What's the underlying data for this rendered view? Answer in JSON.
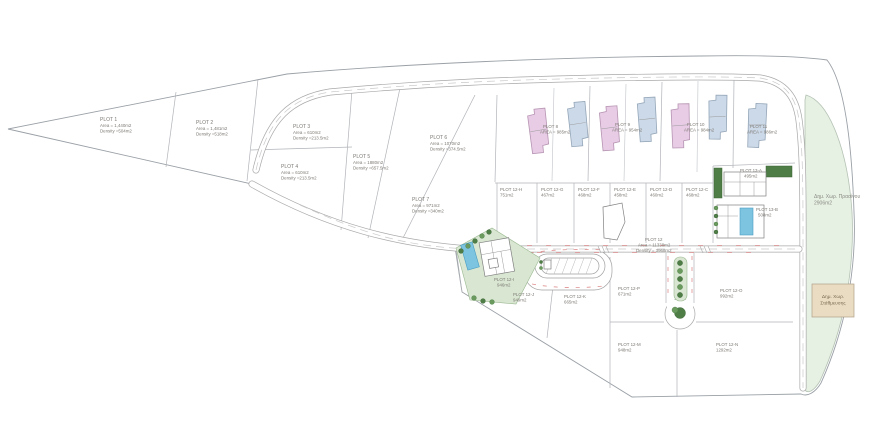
{
  "drawing": {
    "title": "Land development site plan",
    "type": "plot subdivision plan"
  },
  "plots": {
    "p1": {
      "name": "PLOT 1",
      "area": "Area = 1,440m2",
      "density": "Density =504m2"
    },
    "p2": {
      "name": "PLOT 2",
      "area": "Area = 1,481m2",
      "density": "Density =518m2"
    },
    "p3": {
      "name": "PLOT 3",
      "area": "Area = 610m2",
      "density": "Density =213.5m2"
    },
    "p4": {
      "name": "PLOT 4",
      "area": "Area = 610m2",
      "density": "Density =213.5m2"
    },
    "p5": {
      "name": "PLOT 5",
      "area": "Area = 1880m2",
      "density": "Density =657.5m2"
    },
    "p6": {
      "name": "PLOT 6",
      "area": "Area = 1070m2",
      "density": "Density =374.5m2"
    },
    "p7": {
      "name": "PLOT 7",
      "area": "Area = 971m2",
      "density": "Density =340m2"
    },
    "p8": {
      "name": "PLOT 8",
      "area": "AREA = 985m2"
    },
    "p9": {
      "name": "PLOT 9",
      "area": "AREA = 954m2"
    },
    "p10": {
      "name": "PLOT 10",
      "area": "AREA = 984m2"
    },
    "p11": {
      "name": "PLOT 11",
      "area": "AREA = 986m2"
    },
    "p12": {
      "name": "PLOT 12",
      "area": "Area = 11338m2",
      "density": "Density = 3968m2"
    },
    "p12c": {
      "name": "PLOT 12-C",
      "area": "468m2"
    },
    "p12d": {
      "name": "PLOT 12-D",
      "area": "460m2"
    },
    "p12e": {
      "name": "PLOT 12-E",
      "area": "458m2"
    },
    "p12f": {
      "name": "PLOT 12-F",
      "area": "468m2"
    },
    "p12g": {
      "name": "PLOT 12-G",
      "area": "467m2"
    },
    "p12h": {
      "name": "PLOT 12-H",
      "area": "751m2"
    },
    "p12i": {
      "name": "PLOT 12-I",
      "area": "946m2"
    },
    "p12j": {
      "name": "PLOT 12-J",
      "area": "949m2"
    },
    "p12k": {
      "name": "PLOT 12-K",
      "area": "665m2"
    },
    "p12m": {
      "name": "PLOT 12-M",
      "area": "948m2"
    },
    "p12n": {
      "name": "PLOT 12-N",
      "area": "1292m2"
    },
    "p12o": {
      "name": "PLOT 12-O",
      "area": "992m2"
    },
    "p12p": {
      "name": "PLOT 12-P",
      "area": "671m2"
    },
    "p13a": {
      "name": "PLOT 13-A",
      "area": "495m2"
    },
    "p13b": {
      "name": "PLOT 13-B",
      "area": "508m2"
    }
  },
  "public_areas": {
    "green_space": {
      "line1": "Δημ. Χωρ. Πρασίνου",
      "line2": "2906m2"
    },
    "parking": {
      "line1": "Δημ. Χωρ.",
      "line2": "Στάθμευσης"
    }
  },
  "colors": {
    "pink_building": "#e8cce6",
    "blue_building": "#ccd9e8",
    "landscape_green": "#d9e7d2",
    "public_green": "#e6f0e3",
    "tree_green": "#4e7d46",
    "pool_blue": "#7cc4e0",
    "parking_beige": "#e9dcc3",
    "road_marking_red": "#e09090",
    "line_gray": "#9aa0a6"
  }
}
